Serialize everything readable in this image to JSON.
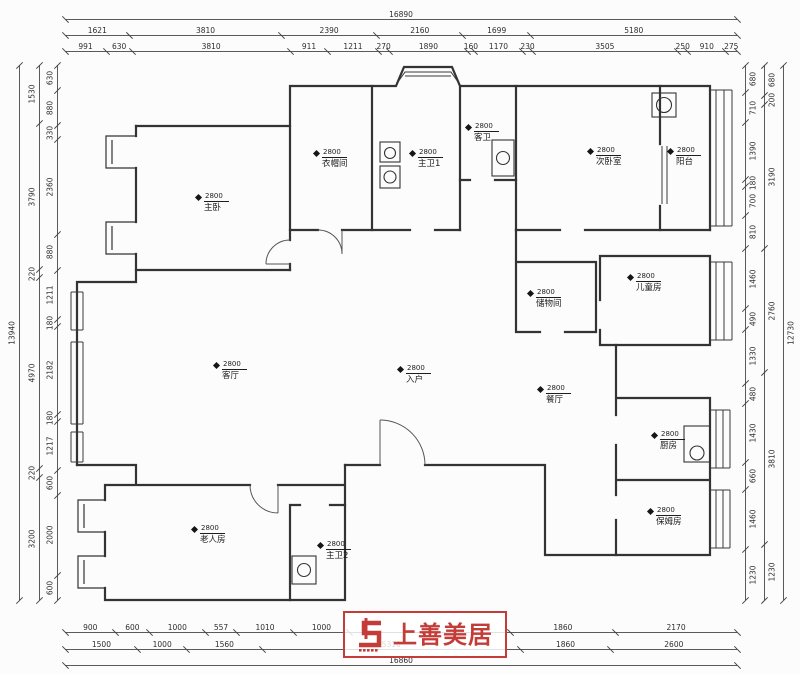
{
  "drawing": {
    "type": "residential floor plan",
    "ceiling_height": "2800"
  },
  "rooms": [
    {
      "name": "主卧",
      "height": "2800"
    },
    {
      "name": "衣帽间",
      "height": "2800"
    },
    {
      "name": "主卫1",
      "height": "2800"
    },
    {
      "name": "客卫",
      "height": "2800"
    },
    {
      "name": "次卧室",
      "height": "2800"
    },
    {
      "name": "阳台",
      "height": "2800"
    },
    {
      "name": "储物间",
      "height": "2800"
    },
    {
      "name": "儿童房",
      "height": "2800"
    },
    {
      "name": "客厅",
      "height": "2800"
    },
    {
      "name": "入户",
      "height": "2800"
    },
    {
      "name": "餐厅",
      "height": "2800"
    },
    {
      "name": "厨房",
      "height": "2800"
    },
    {
      "name": "保姆房",
      "height": "2800"
    },
    {
      "name": "老人房",
      "height": "2800"
    },
    {
      "name": "主卫2",
      "height": "2800"
    }
  ],
  "dimensions": {
    "top_total": [
      16890
    ],
    "top_row2": [
      1621,
      3810,
      2390,
      2160,
      1699,
      5180
    ],
    "top_row3": [
      991,
      630,
      3810,
      911,
      1211,
      270,
      1890,
      160,
      1170,
      230,
      3505,
      250,
      910,
      275
    ],
    "bottom_row1": [
      900,
      600,
      1000,
      557,
      1010,
      1000,
      2870,
      1860,
      2170
    ],
    "bottom_row2": [
      1500,
      1000,
      1560,
      5310,
      1860,
      2600
    ],
    "bottom_total": [
      16860
    ],
    "left_total": [
      13940
    ],
    "left_middle": [
      1530,
      3790,
      220,
      4970,
      220,
      3200
    ],
    "left_inner": [
      630,
      880,
      330,
      2360,
      880,
      1211,
      180,
      2182,
      180,
      1217,
      600,
      2000,
      600
    ],
    "right_inner": [
      680,
      710,
      1390,
      180,
      700,
      810,
      1460,
      490,
      1330,
      480,
      1430,
      660,
      1460,
      1230
    ],
    "right_middle": [
      680,
      200,
      3190,
      2760,
      3810,
      1230
    ],
    "right_total": [
      12730
    ]
  },
  "logo": {
    "text": "上善美居",
    "color": "#c43c38"
  },
  "colors": {
    "wall": "#333333",
    "dimension_line": "#5a5a5a",
    "background": "#fcfcfc"
  }
}
